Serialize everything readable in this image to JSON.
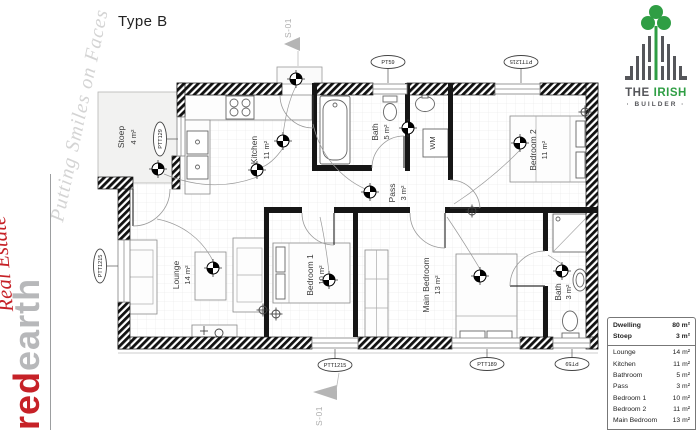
{
  "title": "Type B",
  "brand_left": {
    "tagline": "Putting Smiles on Faces",
    "logo_red": "red",
    "logo_earth": "earth",
    "logo_script": "Real Estate"
  },
  "builder_logo": {
    "word_the": "THE",
    "word_irish": "IRISH",
    "word_builder": "· BUILDER ·"
  },
  "section_markers": {
    "top": "S-01",
    "bottom": "S-01"
  },
  "plan": {
    "rooms": {
      "stoep": {
        "name": "Stoep",
        "area": "4 m²"
      },
      "kitchen": {
        "name": "Kitchen",
        "area": "11 m²"
      },
      "bath": {
        "name": "Bath",
        "area": "5 m²"
      },
      "pass": {
        "name": "Pass",
        "area": "3 m²"
      },
      "bedroom2": {
        "name": "Bedroom 2",
        "area": "11 m²"
      },
      "lounge": {
        "name": "Lounge",
        "area": "14 m²"
      },
      "bedroom1": {
        "name": "Bedroom 1",
        "area": "10 m²"
      },
      "main_bedroom": {
        "name": "Main Bedroom",
        "area": "13 m²"
      },
      "ensuite": {
        "name": "Bath",
        "area": "3 m²"
      }
    },
    "wm_label": "WM",
    "tags": {
      "stoep": "PTT129",
      "top_bath": "PT59",
      "top_bedroom2": "PTT1215",
      "left_lounge": "PTT1215",
      "bottom_bedroom1": "PTT1215",
      "bottom_main": "PTT189",
      "bottom_ensuite": "PT59"
    }
  },
  "summary_table": {
    "header": [
      {
        "label": "Dwelling",
        "value": "80 m²"
      },
      {
        "label": "Stoep",
        "value": "3 m²"
      }
    ],
    "rows": [
      {
        "label": "Lounge",
        "value": "14 m²"
      },
      {
        "label": "Kitchen",
        "value": "11 m²"
      },
      {
        "label": "Bathroom",
        "value": "5 m²"
      },
      {
        "label": "Pass",
        "value": "3 m²"
      },
      {
        "label": "Bedroom 1",
        "value": "10 m²"
      },
      {
        "label": "Bedroom 2",
        "value": "11 m²"
      },
      {
        "label": "Main Bedroom",
        "value": "13 m²"
      }
    ],
    "footer": {
      "label": "En Suite",
      "value": "3 m²"
    }
  },
  "colors": {
    "brand_red": "#c62127",
    "brand_gray": "#b7b8ba",
    "builder_green": "#2f9e44",
    "builder_gray": "#55565a"
  }
}
